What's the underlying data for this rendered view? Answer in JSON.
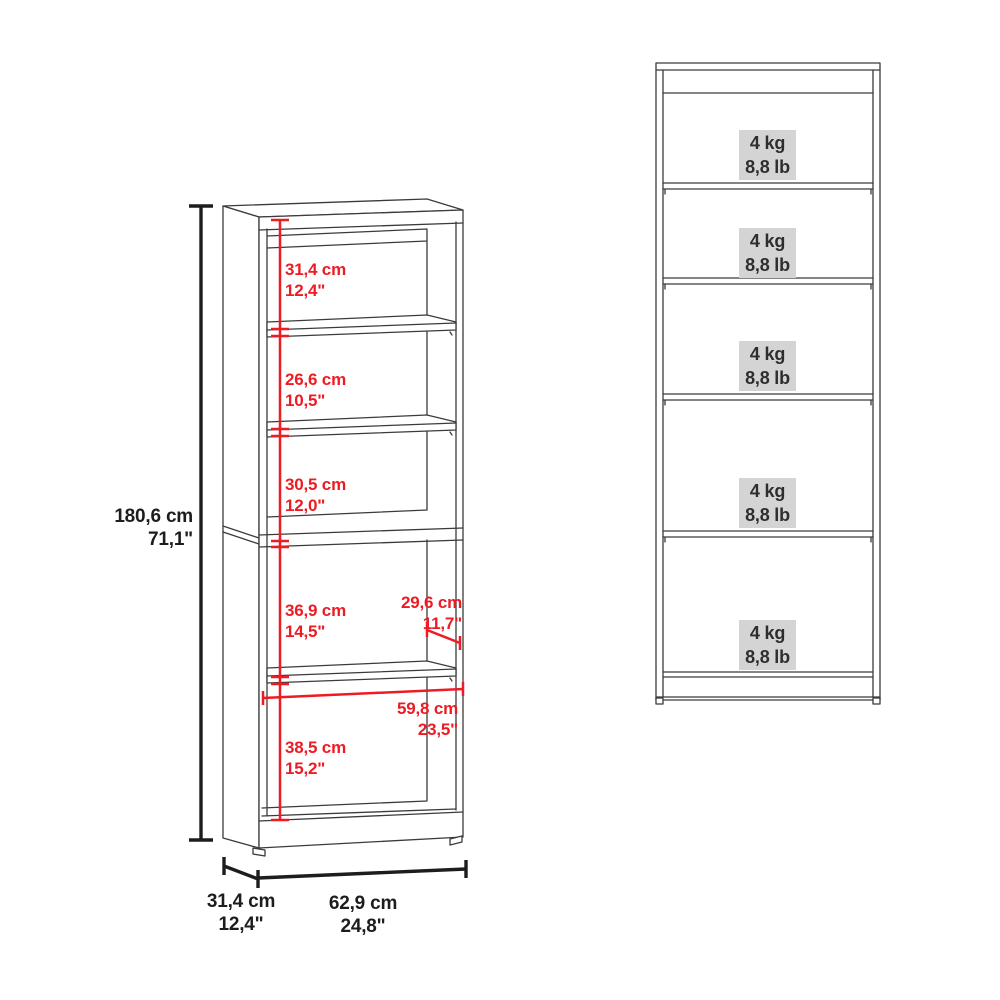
{
  "colors": {
    "background": "#ffffff",
    "dimension_red": "#ed1c24",
    "line_dark": "#3b3b3b",
    "ink": "#1d1d1d",
    "label_bg": "#d4d4d4",
    "text_dark": "#2e2e2e"
  },
  "left_view": {
    "overall_height": {
      "cm": "180,6 cm",
      "inch": "71,1\""
    },
    "sections": [
      {
        "cm": "31,4 cm",
        "inch": "12,4\""
      },
      {
        "cm": "26,6 cm",
        "inch": "10,5\""
      },
      {
        "cm": "30,5 cm",
        "inch": "12,0\""
      },
      {
        "cm": "36,9 cm",
        "inch": "14,5\""
      },
      {
        "cm": "38,5 cm",
        "inch": "15,2\""
      }
    ],
    "inner_depth": {
      "cm": "29,6 cm",
      "inch": "11,7\""
    },
    "inner_width": {
      "cm": "59,8 cm",
      "inch": "23,5\""
    },
    "footprint_depth": {
      "cm": "31,4 cm",
      "inch": "12,4\""
    },
    "footprint_width": {
      "cm": "62,9 cm",
      "inch": "24,8\""
    }
  },
  "right_view": {
    "shelf_capacities": [
      {
        "kg": "4 kg",
        "lb": "8,8 lb"
      },
      {
        "kg": "4 kg",
        "lb": "8,8 lb"
      },
      {
        "kg": "4 kg",
        "lb": "8,8 lb"
      },
      {
        "kg": "4 kg",
        "lb": "8,8 lb"
      },
      {
        "kg": "4 kg",
        "lb": "8,8 lb"
      }
    ]
  }
}
